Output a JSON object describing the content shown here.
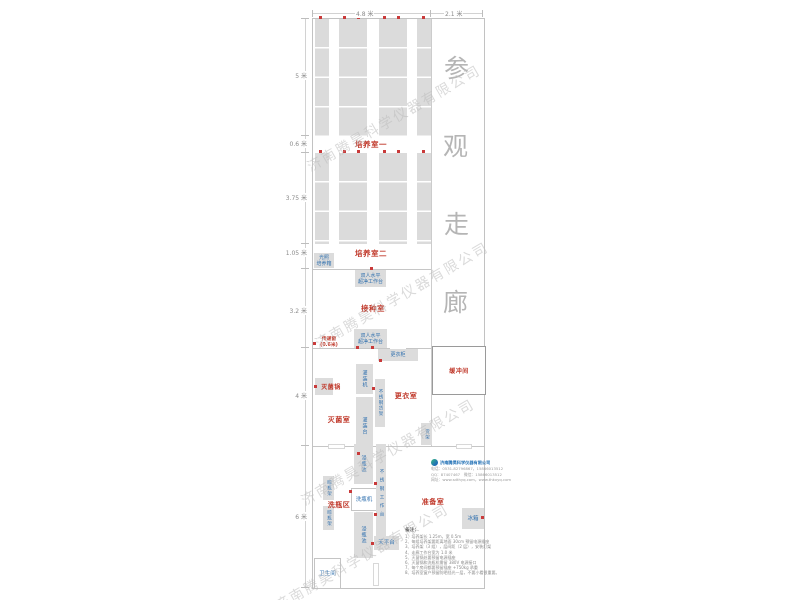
{
  "dimensions": {
    "top": [
      "4.8 米",
      "2.1 米"
    ],
    "left": [
      "5 米",
      "0.6 米",
      "3.75 米",
      "1.05 米",
      "3.2 米",
      "4 米",
      "6 米"
    ]
  },
  "corridor": {
    "chars": [
      "参",
      "观",
      "走",
      "廊"
    ]
  },
  "rooms": {
    "culture_room_1": "培养室一",
    "culture_room_2": "培养室二",
    "inoculation_room": "接种室",
    "sterilization_room": "灭菌室",
    "changing_room": "更衣室",
    "bottle_washing_area": "洗瓶区",
    "preparation_room": "准备室",
    "buffer_room": "缓冲间",
    "toilet": "卫生间"
  },
  "equipment": {
    "light_incubator": [
      "光照",
      "培养箱"
    ],
    "clean_bench": [
      "双人水平",
      "超净工作台"
    ],
    "transfer_window": [
      "传递窗",
      "(0.6米)"
    ],
    "changing_cabinet": "更衣柜",
    "sterilizer": "灭菌锅",
    "filling_machine": "灌装机",
    "stainless_rack": "不锈钢货架",
    "filling_table": "灌装台",
    "soaking_pool": "浸瓶池",
    "stainless_worktable": "不锈钢工作台",
    "bottle_washer": "洗瓶机",
    "drying_rack": "晾瓶架",
    "balance_table": "天平台",
    "shelf": "货架",
    "fridge": "冰箱"
  },
  "watermark": "济南腾昊科学仪器有限公司",
  "company": {
    "name": "济南腾昊科学仪器有限公司",
    "contact_lines": [
      "电话：0531-82796867，15866013512",
      "QQ：87407467　微信：15866013512",
      "网址：www.sdthyq.com，www.thkxyq.com"
    ]
  },
  "notes": {
    "title": "备注：",
    "items": [
      "1、培养架长 1.25m，宽 0.5m",
      "2、每组培养架要距离地面 30cm 预留电源插座",
      "3、培养架（3 组），层间距（2 层），安装灯架",
      "4、走廊工作台宽为 1.0 米",
      "5、灭菌锅处要预留电源插座",
      "6、灭菌锅和洗瓶机需留 380V 电源接口",
      "7、每个房间都要预留插座 +750kg 承重",
      "8、培养室窗户预留防晒挡光一层，不要小看很重要。"
    ]
  }
}
